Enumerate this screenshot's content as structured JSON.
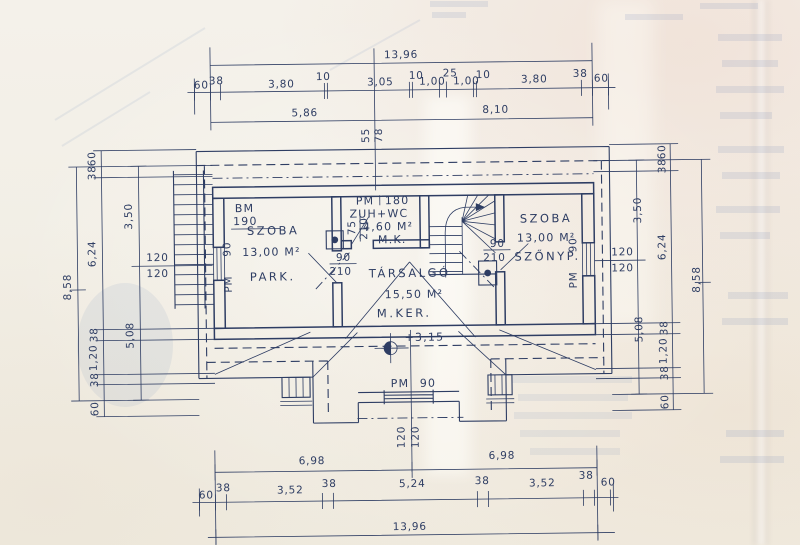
{
  "colors": {
    "ink": "#2e3d63",
    "paper": "#f3efe7"
  },
  "dims": {
    "top_total": "13,96",
    "top_row": [
      "60",
      "38",
      "3,80",
      "10",
      "3,05",
      "10",
      "1,00",
      "25",
      "1,00",
      "10",
      "3,80",
      "38",
      "60"
    ],
    "top_sub": [
      "5,86",
      "8,10"
    ],
    "top_wall": [
      "55",
      "78"
    ],
    "bottom_sub": [
      "6,98",
      "6,98"
    ],
    "bottom_row": [
      "60",
      "38",
      "3,52",
      "38",
      "5,24",
      "38",
      "3,52",
      "38",
      "60"
    ],
    "bottom_total": "13,96",
    "bottom_window": [
      "120",
      "120"
    ],
    "left_total": "8,58",
    "left_chain": [
      "60",
      "38",
      "6,24",
      "38",
      "1,20",
      "38",
      "60"
    ],
    "left_inner": [
      "3,50",
      "5,08"
    ],
    "left_window": [
      "120",
      "120"
    ],
    "right_total": "8,58",
    "right_chain": [
      "60",
      "38",
      "6,24",
      "38",
      "1,20",
      "38",
      "60"
    ],
    "right_inner": [
      "3,50",
      "5,08"
    ],
    "right_window": [
      "120",
      "120"
    ]
  },
  "rooms": {
    "left": {
      "bm_label": "BM",
      "bm_value": "190",
      "name": "SZOBA",
      "area": "13,00 M²",
      "floor": "PARK.",
      "door_w": "90",
      "door_h": "210",
      "window_w": "90",
      "window_pm": "PM"
    },
    "bath": {
      "pm_label": "PM",
      "pm_value": "180",
      "name": "ZUH+WC",
      "area": "4,60 M²",
      "floor": "M.K.",
      "door_w": "75",
      "door_h": "210"
    },
    "lounge": {
      "name": "TÁRSALGÓ",
      "area": "15,50 M²",
      "floor": "M.KER.",
      "level": "+3,15",
      "window_pm": "PM",
      "window_w": "90"
    },
    "right": {
      "name": "SZOBA",
      "area": "13,00 M²",
      "floor": "SZŐNYP.",
      "door_w": "90",
      "door_h": "210",
      "window_w": "90",
      "window_pm": "PM"
    }
  }
}
